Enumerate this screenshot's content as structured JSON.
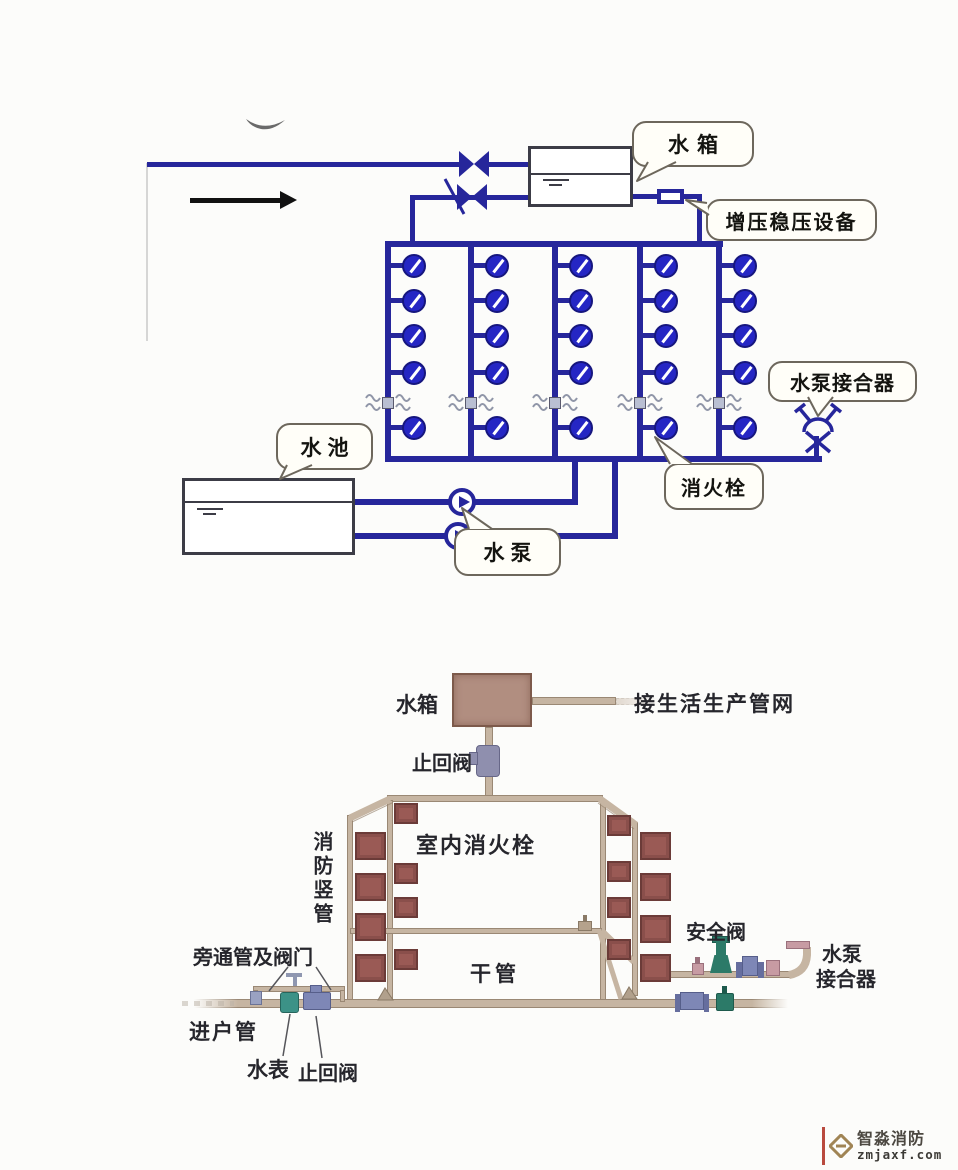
{
  "page": {
    "bg": "#fcfcfa"
  },
  "top_diagram": {
    "bubbles": {
      "tank": "水箱",
      "pressure_device": "增压稳压设备",
      "pump_adapter": "水泵接合器",
      "hydrant": "消火栓",
      "pool": "水池",
      "pump": "水泵"
    },
    "grid": {
      "risers": 5,
      "outlets_per_riser": 5,
      "flex_joints": 5
    },
    "colors": {
      "pipe": "#26269b",
      "outlet_fill": "#2526c4"
    }
  },
  "bottom_diagram": {
    "labels": {
      "tank": "水箱",
      "to_service_network": "接生活生产管网",
      "check_valve_top": "止回阀",
      "indoor_hydrant": "室内消火栓",
      "fire_standpipe": "消防竖管",
      "safety_valve": "安全阀",
      "pump_adapter_line1": "水泵",
      "pump_adapter_line2": "接合器",
      "main_pipe": "干管",
      "bypass_and_valves": "旁通管及阀门",
      "service_entry_pipe": "进户管",
      "water_meter": "水表",
      "check_valve_bottom": "止回阀"
    },
    "hydrant_boxes": {
      "left_front": 4,
      "left_back": 4,
      "right_front": 4,
      "right_back": 4
    },
    "colors": {
      "pipe": "#c6b5a2",
      "hydrant_box": "#9a5a55",
      "valve_green": "#2c7a68",
      "meter_teal": "#3c9287",
      "valve_blue": "#7e87b6",
      "valve_pink": "#c79ba3",
      "valve_purple": "#8f8fae"
    }
  },
  "watermark": {
    "brand": "智淼消防",
    "domain": "zmjaxf.com",
    "mark_color": "#a08454"
  }
}
